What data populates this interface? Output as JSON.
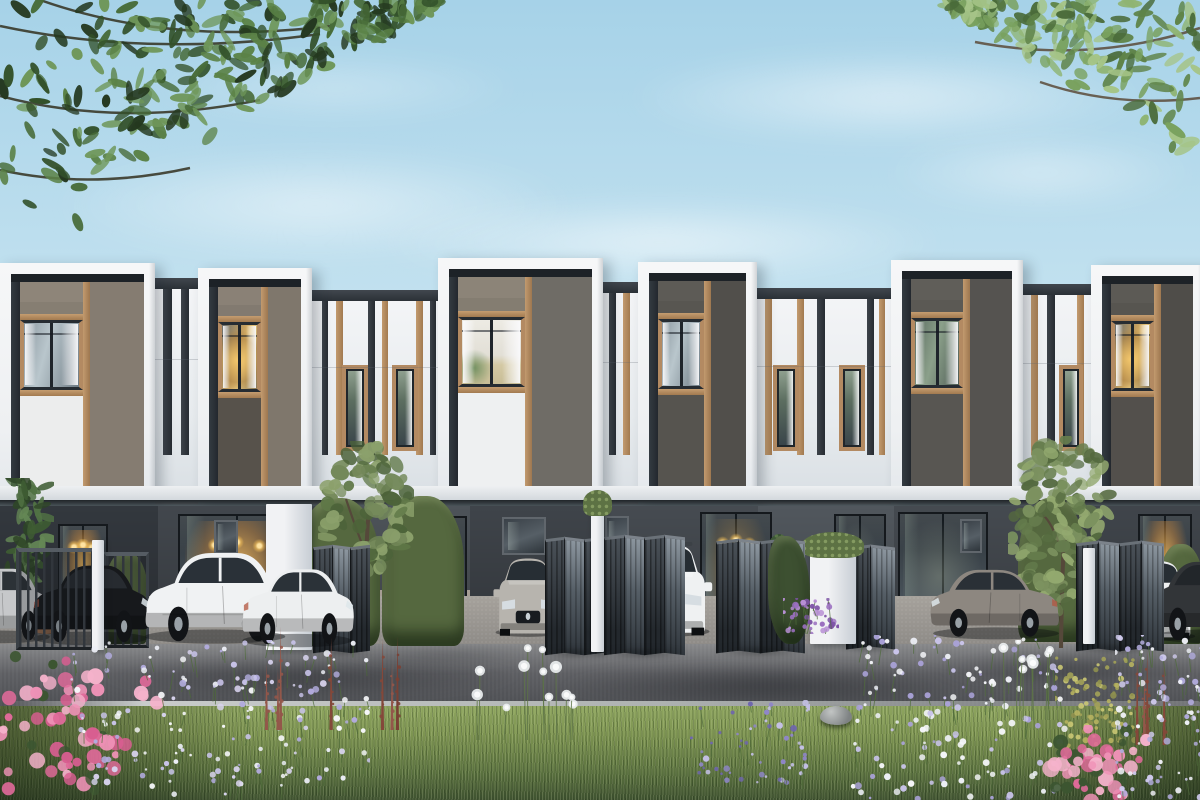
{
  "scene": {
    "canvas": {
      "w": 1200,
      "h": 800
    },
    "sky": {
      "top": "#a6d2e8",
      "mid": "#cde7f2",
      "bottom": "#eff7f9",
      "clouds": [
        {
          "x": 620,
          "y": 50,
          "w": 540,
          "h": 95,
          "o": 0.55
        },
        {
          "x": 50,
          "y": 148,
          "w": 530,
          "h": 115,
          "o": 0.5
        },
        {
          "x": 370,
          "y": 200,
          "w": 580,
          "h": 85,
          "o": 0.6
        },
        {
          "x": 880,
          "y": 135,
          "w": 320,
          "h": 75,
          "o": 0.45
        },
        {
          "x": 140,
          "y": 55,
          "w": 390,
          "h": 65,
          "o": 0.35
        }
      ]
    },
    "canopy": {
      "left": {
        "x": 0,
        "y": 0,
        "w": 450,
        "h": 235,
        "count": 270,
        "seed": 3,
        "palette": [
          "#24381f",
          "#33512a",
          "#476b38",
          "#5b8247",
          "#6f975a"
        ],
        "branches": [
          "M0,26 Q150,58 320,34",
          "M0,96 Q120,128 260,100",
          "M40,0 Q170,46 330,26",
          "M0,170 Q90,190 190,168"
        ],
        "branch_color": "#33301f"
      },
      "right": {
        "x": 935,
        "y": 0,
        "w": 265,
        "h": 160,
        "count": 160,
        "seed": 9,
        "palette": [
          "#4a6b3a",
          "#5f8449",
          "#79a15e",
          "#8fb473",
          "#a5c487"
        ],
        "branches": [
          "M265,28 Q155,64 40,42",
          "M265,98 Q180,108 105,82"
        ],
        "branch_color": "#5a4a38"
      }
    },
    "building": {
      "white": "#f3f4f6",
      "white_shade": "#dde2e7",
      "navy": "#2a3036",
      "wood": "#b38a62",
      "window_row": {
        "y": 373,
        "h": 70
      },
      "band": {
        "y": 486,
        "h": 16,
        "c1": "#eef0f2",
        "c2": "#cfd5da"
      },
      "soffit": {
        "y": 500,
        "h": 9,
        "c": "#1f2428"
      },
      "units": [
        {
          "x": 0,
          "w": 155,
          "top": 263,
          "slat": "#8e8579",
          "flat": "#857c71",
          "lower": "#eceded",
          "win": "cool"
        },
        {
          "x": 198,
          "w": 114,
          "top": 268,
          "slat": "#8a8176",
          "flat": "#7f776c",
          "lower": "#57524b",
          "win": "warm"
        },
        {
          "x": 438,
          "w": 165,
          "top": 258,
          "slat": "#8c8478",
          "flat": "#6f6c66",
          "lower": "#eef0f1",
          "win": "bright"
        },
        {
          "x": 638,
          "w": 119,
          "top": 262,
          "slat": "#5d5b56",
          "flat": "#514f4b",
          "lower": "#56544f",
          "win": "cool"
        },
        {
          "x": 891,
          "w": 132,
          "top": 260,
          "slat": "#605e59",
          "flat": "#555350",
          "lower": "#585652",
          "win": "green"
        },
        {
          "x": 1091,
          "w": 113,
          "top": 265,
          "slat": "#5c5a55",
          "flat": "#4f4d49",
          "lower": "#53504c",
          "win": "warm"
        }
      ],
      "striped": [
        {
          "x": 155,
          "w": 43,
          "top": 278,
          "strips": [
            {
              "o": 8,
              "w": 9,
              "c": "dark"
            },
            {
              "o": 26,
              "w": 8,
              "c": "dark"
            }
          ],
          "windows": []
        },
        {
          "x": 312,
          "w": 126,
          "top": 290,
          "strips": [
            {
              "o": 10,
              "w": 6,
              "c": "dark"
            },
            {
              "o": 24,
              "w": 7,
              "c": "wood"
            },
            {
              "o": 56,
              "w": 7,
              "c": "dark"
            },
            {
              "o": 70,
              "w": 6,
              "c": "wood"
            },
            {
              "o": 104,
              "w": 7,
              "c": "wood"
            },
            {
              "o": 118,
              "w": 6,
              "c": "dark"
            }
          ],
          "windows": [
            {
              "o": 30,
              "w": 26
            },
            {
              "o": 80,
              "w": 26
            }
          ]
        },
        {
          "x": 603,
          "w": 35,
          "top": 282,
          "strips": [
            {
              "o": 6,
              "w": 7,
              "c": "dark"
            },
            {
              "o": 20,
              "w": 7,
              "c": "wood"
            }
          ],
          "windows": []
        },
        {
          "x": 757,
          "w": 134,
          "top": 288,
          "strips": [
            {
              "o": 8,
              "w": 7,
              "c": "wood"
            },
            {
              "o": 40,
              "w": 7,
              "c": "wood"
            },
            {
              "o": 60,
              "w": 8,
              "c": "dark"
            },
            {
              "o": 110,
              "w": 7,
              "c": "dark"
            },
            {
              "o": 122,
              "w": 6,
              "c": "wood"
            }
          ],
          "windows": [
            {
              "o": 16,
              "w": 26
            },
            {
              "o": 82,
              "w": 26
            }
          ]
        },
        {
          "x": 1023,
          "w": 68,
          "top": 284,
          "strips": [
            {
              "o": 8,
              "w": 7,
              "c": "wood"
            },
            {
              "o": 24,
              "w": 8,
              "c": "dark"
            },
            {
              "o": 54,
              "w": 7,
              "c": "wood"
            }
          ],
          "windows": [
            {
              "o": 36,
              "w": 24
            }
          ]
        }
      ]
    },
    "ground": {
      "wall": {
        "y": 506,
        "h": 142
      },
      "segments": [
        {
          "x": 0,
          "w": 158,
          "c": "#33383e"
        },
        {
          "x": 158,
          "w": 172,
          "c": "#42474d"
        },
        {
          "x": 330,
          "w": 140,
          "c": "#4d5359",
          "plinth": "#a79f96"
        },
        {
          "x": 470,
          "w": 132,
          "c": "#3f444a"
        },
        {
          "x": 602,
          "w": 156,
          "c": "#464b51",
          "plinth": "#b2aba0"
        },
        {
          "x": 758,
          "w": 136,
          "c": "#51575d",
          "plinth": "#b0a99e"
        },
        {
          "x": 894,
          "w": 130,
          "c": "#454a50"
        },
        {
          "x": 1024,
          "w": 70,
          "c": "#3c4146"
        },
        {
          "x": 1094,
          "w": 106,
          "c": "#40454b"
        }
      ],
      "doors": [
        {
          "x": 58,
          "w": 50,
          "y": 524,
          "h": 96,
          "glow": "warm",
          "pendants": true
        },
        {
          "x": 178,
          "w": 118,
          "y": 514,
          "h": 130,
          "glow": "warm",
          "pendants": true
        },
        {
          "x": 393,
          "w": 74,
          "y": 516,
          "h": 126,
          "glow": "warm"
        },
        {
          "x": 700,
          "w": 72,
          "y": 512,
          "h": 130,
          "glow": "dim",
          "pendants": true
        },
        {
          "x": 834,
          "w": 52,
          "y": 514,
          "h": 126,
          "glow": "faint"
        },
        {
          "x": 898,
          "w": 90,
          "y": 512,
          "h": 128,
          "glow": "faint"
        },
        {
          "x": 1138,
          "w": 54,
          "y": 514,
          "h": 124,
          "glow": "warm"
        }
      ],
      "small_windows": [
        {
          "x": 214,
          "y": 520,
          "w": 24,
          "h": 34
        },
        {
          "x": 502,
          "y": 517,
          "w": 44,
          "h": 38
        },
        {
          "x": 605,
          "y": 516,
          "w": 24,
          "h": 38
        },
        {
          "x": 960,
          "y": 519,
          "w": 22,
          "h": 34
        }
      ],
      "posts": [
        {
          "x": 92,
          "w": 12,
          "y": 540,
          "h": 110,
          "z": 30
        },
        {
          "x": 266,
          "w": 46,
          "y": 504,
          "h": 146,
          "z": 25
        },
        {
          "x": 591,
          "w": 13,
          "y": 506,
          "h": 146,
          "z": 31,
          "planter": true
        },
        {
          "x": 810,
          "w": 46,
          "y": 548,
          "h": 96,
          "z": 28,
          "planter": true
        },
        {
          "x": 1083,
          "w": 12,
          "y": 548,
          "h": 96,
          "z": 30
        }
      ],
      "hedges": [
        {
          "x": 104,
          "y": 552,
          "w": 44,
          "h": 92,
          "z": 24
        },
        {
          "x": 296,
          "y": 498,
          "w": 84,
          "h": 148,
          "z": 24
        },
        {
          "x": 382,
          "y": 496,
          "w": 82,
          "h": 150,
          "z": 24
        },
        {
          "x": 1018,
          "y": 498,
          "w": 68,
          "h": 144,
          "z": 24
        },
        {
          "x": 1158,
          "y": 544,
          "w": 46,
          "h": 100,
          "z": 26
        },
        {
          "x": 768,
          "y": 536,
          "w": 42,
          "h": 108,
          "z": 30,
          "dark": true
        }
      ],
      "gates": [
        {
          "x": 16,
          "y": 548,
          "w": 78,
          "h": 102,
          "style": "closed",
          "z": 29
        },
        {
          "x": 103,
          "y": 552,
          "w": 46,
          "h": 96,
          "style": "closed",
          "z": 26
        },
        {
          "x": 313,
          "y": 546,
          "w": 56,
          "h": 106,
          "style": "folded",
          "panels": 3,
          "z": 26
        },
        {
          "x": 545,
          "y": 538,
          "w": 58,
          "h": 116,
          "style": "folded",
          "panels": 3,
          "z": 29
        },
        {
          "x": 604,
          "y": 536,
          "w": 80,
          "h": 118,
          "style": "folded",
          "panels": 4,
          "z": 30
        },
        {
          "x": 716,
          "y": 540,
          "w": 88,
          "h": 112,
          "style": "folded",
          "panels": 4,
          "z": 29
        },
        {
          "x": 846,
          "y": 546,
          "w": 48,
          "h": 102,
          "style": "folded",
          "panels": 2,
          "z": 27
        },
        {
          "x": 1076,
          "y": 542,
          "w": 86,
          "h": 108,
          "style": "folded",
          "panels": 4,
          "z": 29
        }
      ],
      "plant_left": {
        "x": 2,
        "y": 478,
        "w": 52,
        "h": 158,
        "seed": 5,
        "count": 70,
        "palette": [
          "#2e4527",
          "#3e5c33",
          "#517244",
          "#648755"
        ],
        "pot": {
          "x": 30,
          "y": 602,
          "w": 38,
          "h": 32,
          "c": "#7d5a42"
        }
      },
      "conifer": {
        "x": 762,
        "y": 534,
        "w": 34,
        "h": 80,
        "pot": {
          "x": 768,
          "y": 606,
          "w": 24,
          "h": 26,
          "c": "#eceeef"
        }
      }
    },
    "cars": [
      {
        "kind": "sedan",
        "x": -58,
        "y": 556,
        "w": 112,
        "h": 88,
        "body": "#c6c8ca",
        "glass": "#2c3237",
        "facing": "right",
        "z": 27
      },
      {
        "kind": "sedan",
        "x": 28,
        "y": 552,
        "w": 124,
        "h": 94,
        "body": "#17191c",
        "glass": "#272b30",
        "facing": "right",
        "z": 27
      },
      {
        "kind": "suv",
        "x": 140,
        "y": 542,
        "w": 150,
        "h": 104,
        "body": "#f0f2f3",
        "glass": "#2a3138",
        "facing": "right",
        "z": 30
      },
      {
        "kind": "sedan",
        "x": 238,
        "y": 556,
        "w": 118,
        "h": 92,
        "body": "#edeff0",
        "glass": "#2b3238",
        "facing": "right",
        "z": 31
      },
      {
        "kind": "front",
        "x": 492,
        "y": 554,
        "w": 72,
        "h": 84,
        "body": "#b7b4ae",
        "glass": "#272e34",
        "z": 27
      },
      {
        "kind": "frontsuv",
        "x": 624,
        "y": 542,
        "w": 90,
        "h": 96,
        "body": "#eff1f2",
        "glass": "#262d33",
        "z": 28
      },
      {
        "kind": "sedan",
        "x": 928,
        "y": 558,
        "w": 136,
        "h": 82,
        "body": "#8d8780",
        "glass": "#2a3036",
        "facing": "left",
        "z": 27
      },
      {
        "kind": "front",
        "x": 1104,
        "y": 556,
        "w": 96,
        "h": 86,
        "body": "#ebedee",
        "glass": "#272e34",
        "z": 28
      },
      {
        "kind": "sedan",
        "x": 1148,
        "y": 548,
        "w": 132,
        "h": 96,
        "body": "#323538",
        "glass": "#22262a",
        "facing": "left",
        "z": 28
      }
    ],
    "paving": {
      "apron": {
        "y": 596,
        "h": 52,
        "c1": "#a6a29c",
        "c2": "#8d8a86"
      },
      "road": {
        "y": 644,
        "h": 66,
        "c1": "#87888a",
        "c2": "#5e5f63",
        "c3": "#4b4d51",
        "patches": [
          {
            "x": 90,
            "y": 654,
            "w": 440,
            "h": 46,
            "o": 0.45
          },
          {
            "x": 550,
            "y": 664,
            "w": 440,
            "h": 44,
            "o": 0.5
          },
          {
            "x": 930,
            "y": 648,
            "w": 280,
            "h": 40,
            "o": 0.45
          },
          {
            "x": 330,
            "y": 645,
            "w": 220,
            "h": 20,
            "o": 0.3
          }
        ]
      },
      "curb": {
        "y": 701,
        "h": 10,
        "c": "#c9cccb"
      }
    },
    "lawn": {
      "y": 706,
      "h": 94,
      "c1": "#8ea55f",
      "c2": "#7d9451",
      "c3": "#5d7440",
      "c4": "#3f5230"
    },
    "rock": {
      "x": 820,
      "y": 706,
      "w": 32,
      "h": 19
    },
    "trees": [
      {
        "x": 318,
        "y": 441,
        "w": 96,
        "h": 206,
        "foliage_h": 145,
        "seed": 7,
        "count": 85,
        "palette": [
          "#5f7747",
          "#74895a",
          "#8ba06b",
          "#4c6339"
        ],
        "trunk": "#55483a"
      },
      {
        "x": 1008,
        "y": 436,
        "w": 110,
        "h": 212,
        "foliage_h": 198,
        "seed": 11,
        "count": 140,
        "palette": [
          "#667d4d",
          "#7b915f",
          "#93a96f",
          "#54693f"
        ],
        "trunk": "#55483a"
      }
    ],
    "flowers": [
      {
        "type": "azalea",
        "x": -15,
        "y": 650,
        "w": 185,
        "h": 150,
        "seed": 21,
        "count": 64,
        "palette": [
          "#ef92b7",
          "#e06a9a",
          "#f5b2cb",
          "#d85e90"
        ]
      },
      {
        "type": "mixed",
        "x": 70,
        "y": 640,
        "w": 300,
        "h": 160,
        "seed": 22,
        "count": 170,
        "palette": [
          "#c9c4ea",
          "#eceef6",
          "#b2abdd",
          "#f6f7fa",
          "#d8d3ee"
        ]
      },
      {
        "type": "spikes",
        "x": 265,
        "y": 625,
        "w": 140,
        "h": 105,
        "seed": 23,
        "count": 7,
        "palette": [
          "#84483a",
          "#93574a",
          "#7a4034"
        ]
      },
      {
        "type": "puffs",
        "x": 470,
        "y": 640,
        "w": 110,
        "h": 100,
        "seed": 24,
        "count": 12,
        "palette": [
          "#eceff0"
        ]
      },
      {
        "type": "mixed",
        "x": 690,
        "y": 700,
        "w": 120,
        "h": 90,
        "seed": 25,
        "count": 55,
        "palette": [
          "#8f86c9",
          "#6f66ad",
          "#c4c0e6"
        ]
      },
      {
        "type": "mixed",
        "x": 850,
        "y": 635,
        "w": 220,
        "h": 165,
        "seed": 26,
        "count": 150,
        "palette": [
          "#c9c4ea",
          "#eff1f8",
          "#aaa2d8",
          "#f6f7fa"
        ]
      },
      {
        "type": "puffs",
        "x": 990,
        "y": 640,
        "w": 70,
        "h": 80,
        "seed": 27,
        "count": 8,
        "palette": [
          "#eceff0"
        ]
      },
      {
        "type": "shrub",
        "x": 1055,
        "y": 655,
        "w": 80,
        "h": 95,
        "seed": 28,
        "count": 95,
        "palette": [
          "#b7b261",
          "#cbc874",
          "#8f904f",
          "#a3a258"
        ]
      },
      {
        "type": "spikes",
        "x": 1135,
        "y": 645,
        "w": 60,
        "h": 100,
        "seed": 29,
        "count": 5,
        "palette": [
          "#84483a",
          "#93574a"
        ]
      },
      {
        "type": "azalea",
        "x": 1025,
        "y": 725,
        "w": 125,
        "h": 85,
        "seed": 30,
        "count": 48,
        "palette": [
          "#ef92b7",
          "#e06a9a",
          "#f5b2cb"
        ]
      },
      {
        "type": "mixed",
        "x": 1115,
        "y": 635,
        "w": 95,
        "h": 165,
        "seed": 31,
        "count": 95,
        "palette": [
          "#cfcaed",
          "#f1f2f9",
          "#b2abdd"
        ]
      },
      {
        "type": "mixed",
        "x": 783,
        "y": 598,
        "w": 56,
        "h": 36,
        "seed": 32,
        "count": 42,
        "palette": [
          "#9b6fc0",
          "#b78fd4",
          "#7d53a6"
        ],
        "z": 31
      }
    ]
  }
}
